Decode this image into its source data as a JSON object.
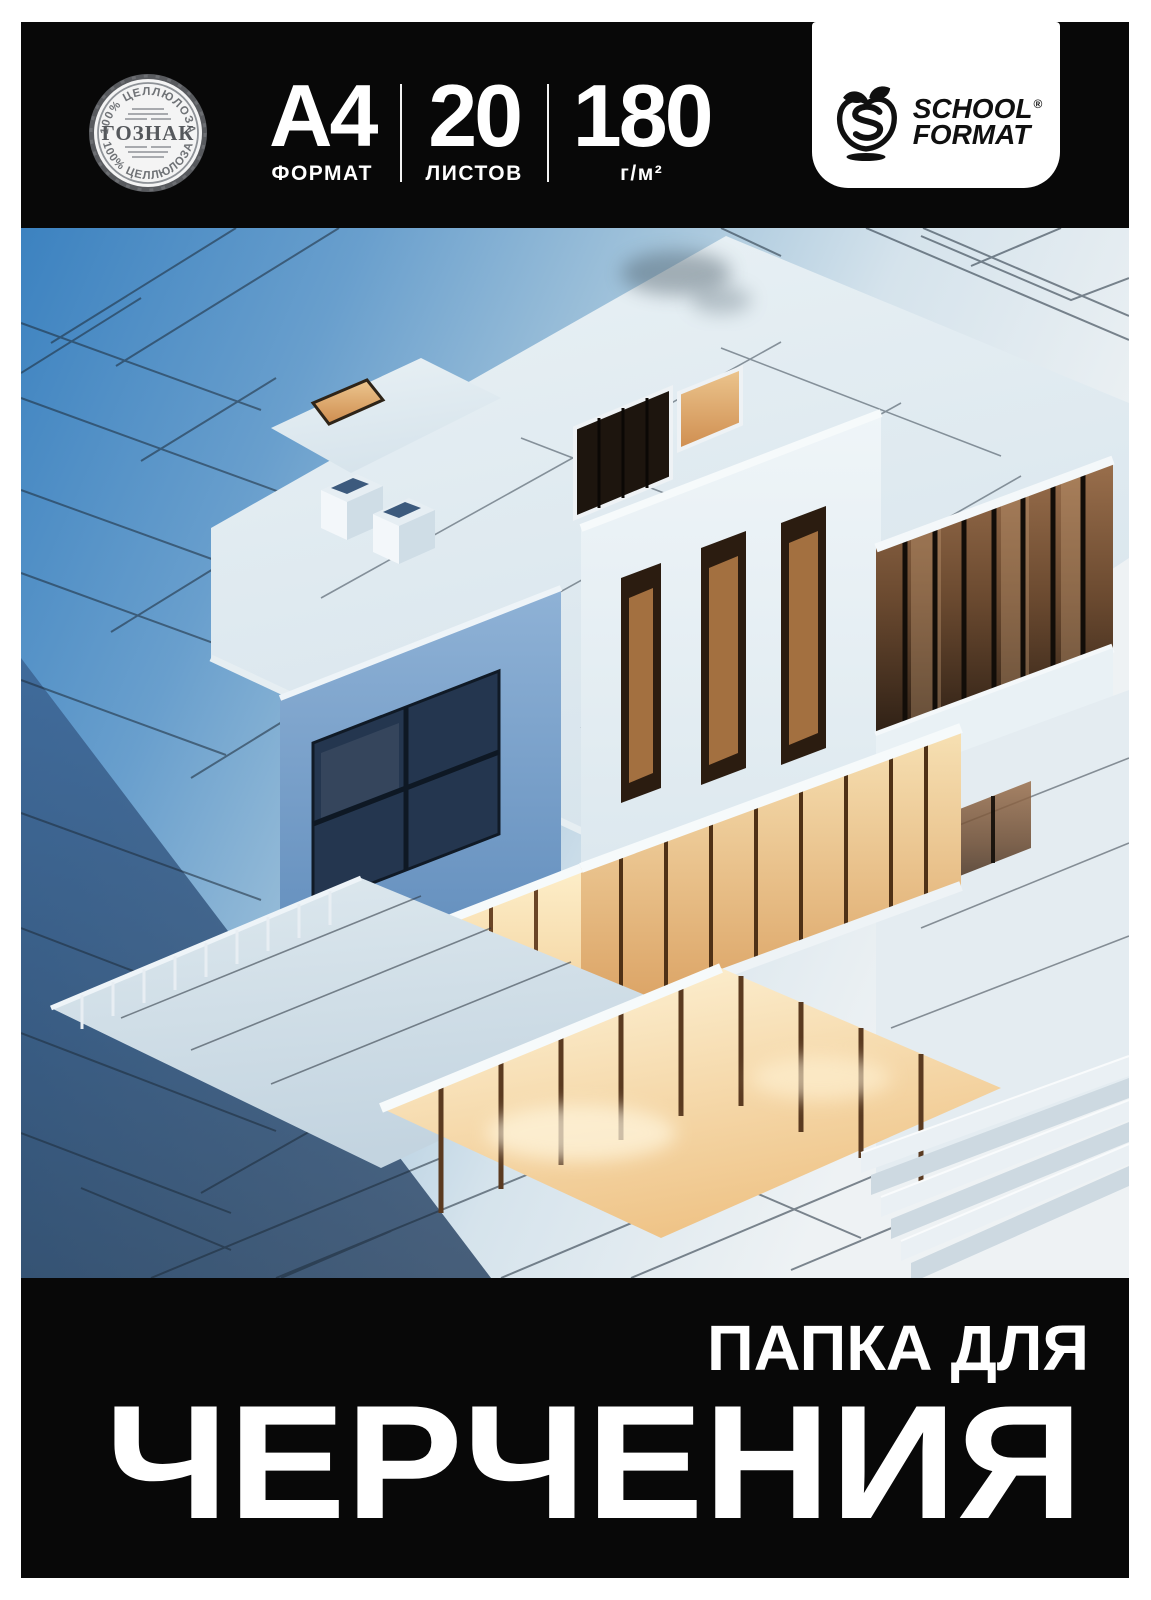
{
  "cover": {
    "header": {
      "seal": {
        "icon": "goznak-certification-seal",
        "top_arc": "100% ЦЕЛЛЮЛОЗА",
        "center": "ГОЗНАК",
        "bottom_arc": "100% ЦЕЛЛЮЛОЗА"
      },
      "specs": [
        {
          "value": "A4",
          "label": "ФОРМАТ"
        },
        {
          "value": "20",
          "label": "ЛИСТОВ"
        },
        {
          "value": "180",
          "label": "г/м²"
        }
      ],
      "brand": {
        "icon": "apple-s-logo",
        "line1": "SCHOOL",
        "registered": "®",
        "line2": "FORMAT"
      }
    },
    "artwork": {
      "icon": "isometric-house-blueprint-render",
      "colors": {
        "blueprint_blue": "#3c82c0",
        "deep_navy": "#2a4a6e",
        "pale_roof": "#e3edf2",
        "white_slab": "#f6fafb",
        "warm_glow": "#f5d9a8",
        "amber_glass": "#6b4a30",
        "line": "#1d2b39"
      }
    },
    "footer": {
      "subtitle": "ПАПКА ДЛЯ",
      "title": "ЧЕРЧЕНИЯ"
    },
    "colors": {
      "cover_bg": "#080808",
      "text": "#ffffff",
      "seal_gray": "#8e9297",
      "brand_black": "#101010"
    }
  }
}
